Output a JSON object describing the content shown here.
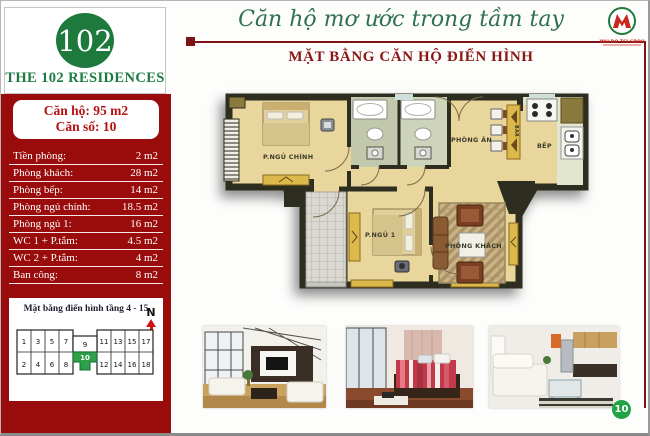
{
  "page": {
    "number": "10"
  },
  "header": {
    "slogan": "Căn hộ mơ ước trong tầm tay",
    "title": "MẶT BẰNG CĂN HỘ ĐIỂN HÌNH",
    "logo_text": "KINH DO TCI GROUP"
  },
  "sidebar": {
    "logo_number": "102",
    "project_name": "THE 102 RESIDENCES",
    "unit_area": "Căn hộ: 95 m2",
    "unit_number": "Căn số: 10",
    "rooms": [
      {
        "label": "Tiền phòng:",
        "value": "2 m2"
      },
      {
        "label": "Phòng khách:",
        "value": "28 m2"
      },
      {
        "label": "Phòng bếp:",
        "value": "14 m2"
      },
      {
        "label": "Phòng ngủ chính:",
        "value": "18.5 m2"
      },
      {
        "label": "Phòng ngủ 1:",
        "value": "16 m2"
      },
      {
        "label": "WC 1 + P.tắm:",
        "value": "4.5 m2"
      },
      {
        "label": "WC 2 + P.tắm:",
        "value": "4 m2"
      },
      {
        "label": "Ban công:",
        "value": "8 m2"
      }
    ],
    "floor_diagram": {
      "title": "Mặt bằng điển hình tầng 4 - 15",
      "north_label": "N",
      "top_row": [
        "1",
        "3",
        "5",
        "7",
        "9",
        "11",
        "13",
        "15",
        "17"
      ],
      "bottom_row": [
        "2",
        "4",
        "6",
        "8",
        "10",
        "12",
        "14",
        "16",
        "18"
      ],
      "highlighted_unit": "10"
    }
  },
  "floor_plan": {
    "labels": {
      "master_bedroom": "P.NGỦ CHÍNH",
      "dining": "PHÒNG ĂN",
      "bar": "BAR",
      "kitchen": "BẾP",
      "bedroom1": "P.NGỦ 1",
      "living": "PHÒNG KHÁCH"
    }
  },
  "colors": {
    "sidebar_red": "#9A0B0B",
    "brand_green": "#1E7A3C",
    "title_red": "#8A1616",
    "rule_red": "#7C1416",
    "badge_green": "#1FA344",
    "unit_highlight_green": "#2FA04A",
    "plan_wall": "#2E2E20",
    "plan_floor": "#E9D69D"
  }
}
